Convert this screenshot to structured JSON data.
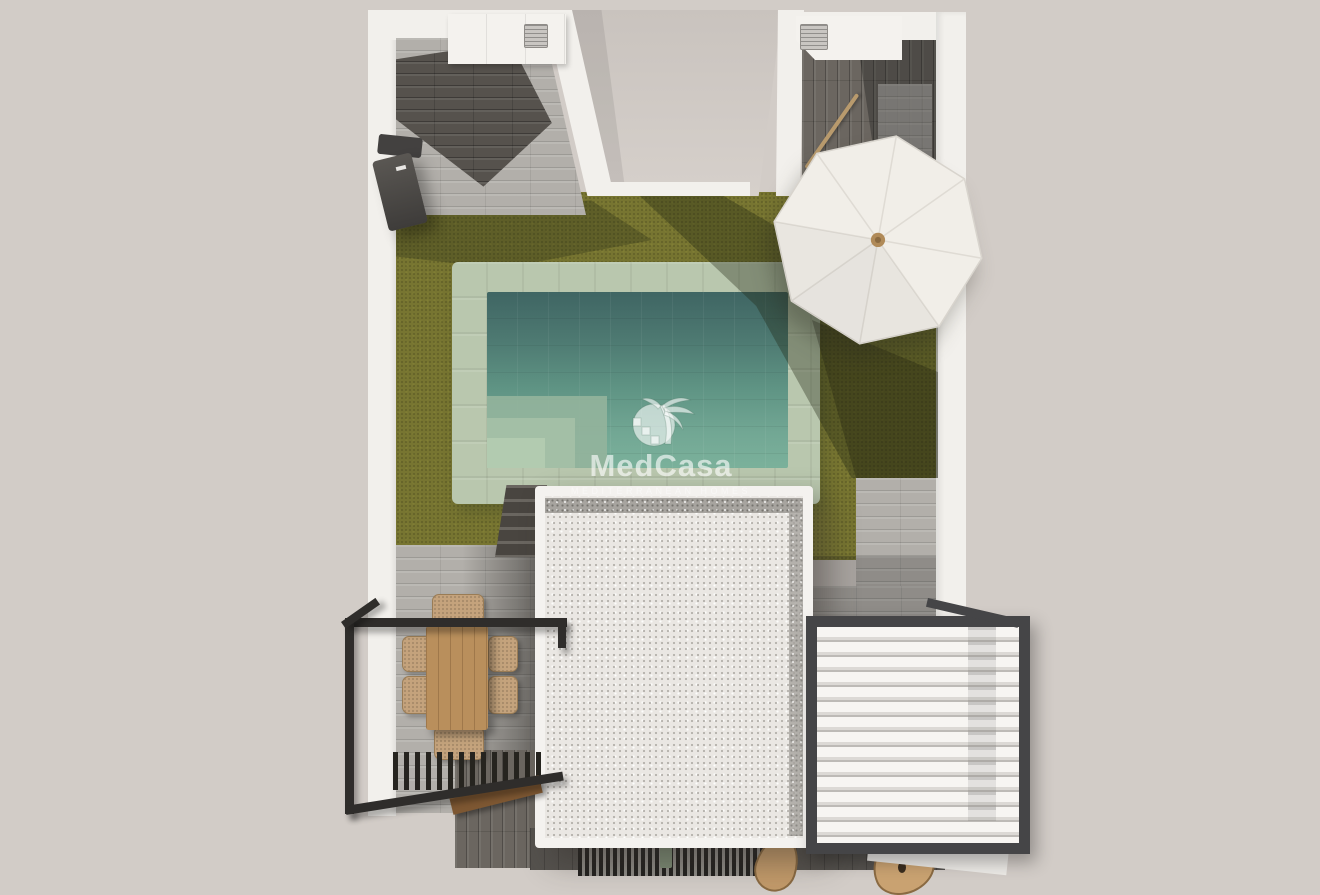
{
  "watermark": {
    "brand": "MedCasa",
    "tagline": "MEDITERRANEAN HOMES",
    "logo": "palm-tree-sun-logo"
  },
  "colors": {
    "background": "#d2ccc7",
    "wall_white": "#f2f0ec",
    "lawn": "#777531",
    "pool_coping": "#b9c7ae",
    "pool_water_light": "#7bb19b",
    "pool_water_dark": "#3f6563",
    "tile_light": "#b2afaa",
    "tile_dark": "#56524d",
    "roof_gravel": "#eae7e3",
    "roof_band": "#a7a49f",
    "pergola_frame": "#2f2d2b",
    "louver_white": "#f3f1ee",
    "wood_table": "#b98f5c",
    "wicker_chair": "#c4a37c",
    "umbrella": "#f1eee8",
    "wood_pole": "#b89a6d",
    "bench_wood": "#7d5732",
    "watermark_text": "rgba(255,255,255,0.62)"
  },
  "objects": [
    "perimeter-walls",
    "garden-lawn",
    "swimming-pool",
    "pool-steps",
    "garden-parasol",
    "villa-gravel-roof",
    "dining-pergola",
    "dining-table",
    "dining-chairs",
    "louvered-pergola",
    "air-conditioning-units",
    "storage-counters",
    "garden-stairs",
    "wall-mounted-fixture",
    "tile-paths",
    "wooden-bench",
    "floor-grate",
    "decor-boards"
  ]
}
